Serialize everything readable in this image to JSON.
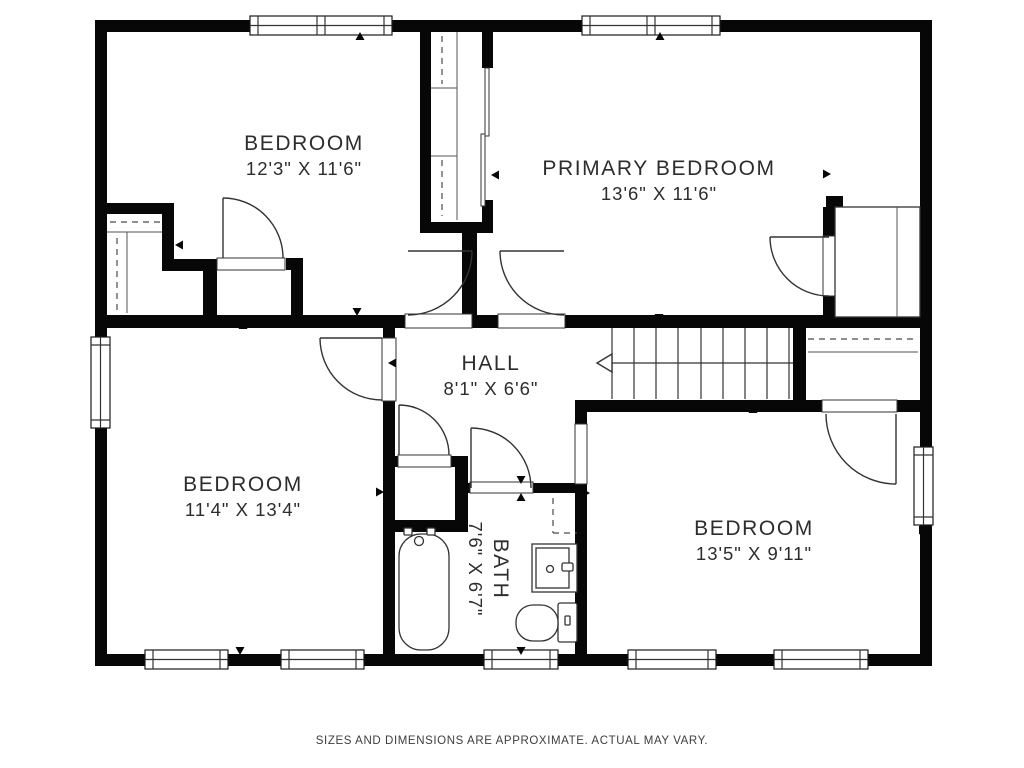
{
  "rooms": [
    {
      "id": "bedroom-top-left",
      "label": "BEDROOM",
      "dims": "12'3\" X 11'6\""
    },
    {
      "id": "primary-bedroom",
      "label": "PRIMARY BEDROOM",
      "dims": "13'6\" X 11'6\""
    },
    {
      "id": "hall",
      "label": "HALL",
      "dims": "8'1\" X 6'6\""
    },
    {
      "id": "bedroom-bottom-left",
      "label": "BEDROOM",
      "dims": "11'4\" X 13'4\""
    },
    {
      "id": "bath",
      "label": "BATH",
      "dims": "7'6\" X 6'7\""
    },
    {
      "id": "bedroom-bottom-right",
      "label": "BEDROOM",
      "dims": "13'5\" X 9'11\""
    }
  ],
  "caption": "SIZES AND DIMENSIONS ARE APPROXIMATE. ACTUAL MAY VARY.",
  "icons": [
    "bathtub",
    "toilet",
    "sink-vanity",
    "staircase-up-arrow",
    "door-swing",
    "window",
    "closet-rod-dashed-line",
    "dimension-marker",
    "sliding-closet-door"
  ],
  "colors": {
    "wall": "#070707",
    "line": "#333333",
    "text": "#2d2d2d",
    "dash": "#4a4a4a",
    "background": "#ffffff"
  }
}
